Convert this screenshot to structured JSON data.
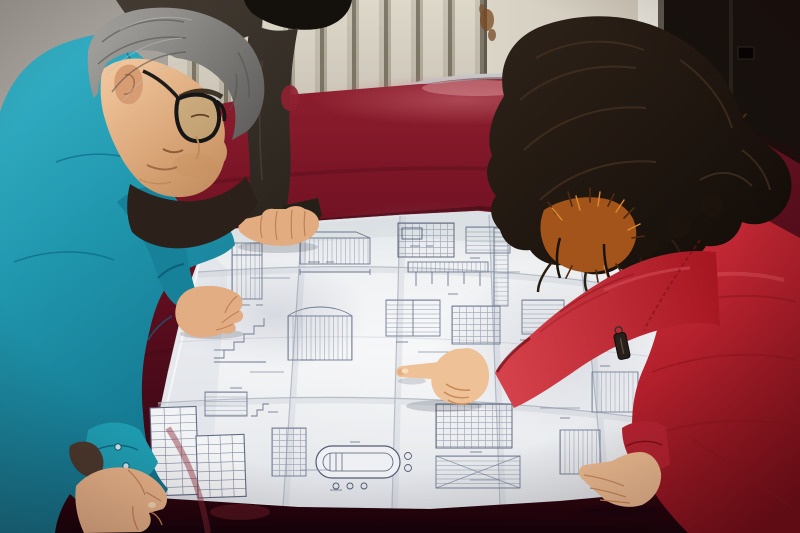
{
  "scene": {
    "title": "Workers reviewing a large engineering blueprint on a red velvet table",
    "setting": "Indoor room with a white slatted radiator, cream door and dark panel behind; a folding chair behind the table",
    "people": [
      {
        "id": "engineer-teal",
        "description": "Middle-aged man in a teal work jacket, gray hair and dark glasses, leaning over the drawing with both hands on the sheet"
      },
      {
        "id": "second-worker",
        "description": "Person in a dark jacket standing behind the man, one hand resting on the top edge of the sheet"
      },
      {
        "id": "visitor-red",
        "description": "Woman in a bright red parka with orange fur-trimmed hood and long dark wavy hair, pointing at a detail on the blueprint"
      }
    ],
    "objects": [
      {
        "id": "blueprint",
        "description": "Large folded white construction drawing sheet covered with structural details, schedules and a title block"
      },
      {
        "id": "velvet-table",
        "description": "Table draped in dark crimson velvet"
      },
      {
        "id": "radiator",
        "description": "Cream vertical-slat radiator along the back wall"
      },
      {
        "id": "chair",
        "description": "Metal-frame chair with red back behind the table"
      }
    ]
  },
  "palette": {
    "wall": "#a6a29b",
    "radiatorSlat": "#ded8ca",
    "radiatorGap": "#81796a",
    "doorCream": "#d9d4c6",
    "doorEdge": "#e9e6dc",
    "doorFrame": "#5f594f",
    "panelDark": "#17120e",
    "chairMetal": "#c6c9cb",
    "chairRed": "#8c2130",
    "velvet": "#6b1222",
    "velvetDeep": "#24040c",
    "velvetGlow": "#c86a72",
    "paper": "#edeff1",
    "paperShade": "#c2c8d2",
    "inkLine": "#6e7890",
    "inkDark": "#515c74",
    "teal": "#1f95ac",
    "tealDeep": "#117089",
    "tealLight": "#35b1c6",
    "skin": "#e6b289",
    "skinShadow": "#c08457",
    "hairGray": "#8a8884",
    "secondJacket": "#352e27",
    "secondHair": "#14100c",
    "redCoat": "#c22734",
    "redCoatDeep": "#7e0f1a",
    "redCoatLight": "#d6424c",
    "furOrange": "#ad5c1d",
    "furDark": "#5e3110",
    "furLight": "#e8963a",
    "womanHair": "#1c130d"
  }
}
